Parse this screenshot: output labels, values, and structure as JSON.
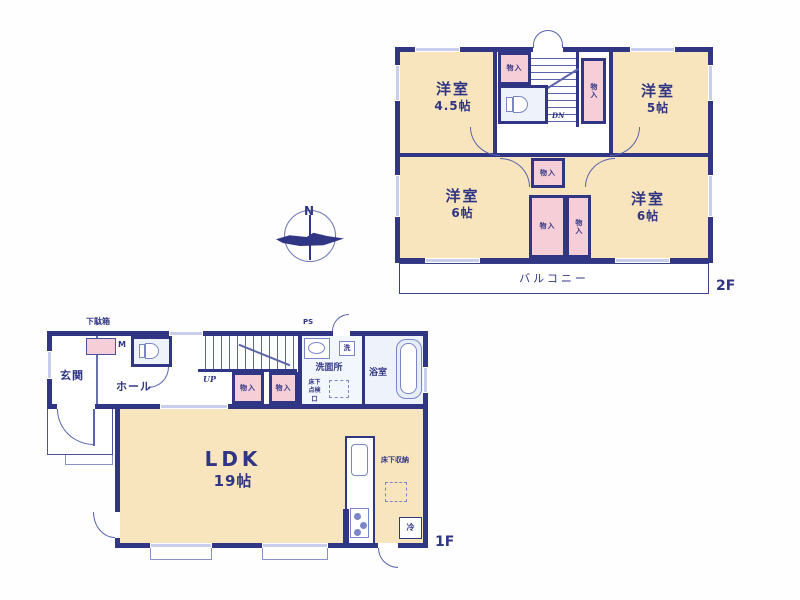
{
  "compass": {
    "label": "N"
  },
  "colors": {
    "wall": "#303683",
    "room_fill": "#f8e4bd",
    "closet_fill": "#f6ced7",
    "wet_fill": "#eef3fb",
    "window": "#c9cdee"
  },
  "floor2": {
    "label": "2F",
    "rooms": [
      {
        "name": "bedroom-nw",
        "label": "洋室",
        "size": "4.5帖"
      },
      {
        "name": "bedroom-ne",
        "label": "洋室",
        "size": "5帖"
      },
      {
        "name": "bedroom-sw",
        "label": "洋室",
        "size": "6帖"
      },
      {
        "name": "bedroom-se",
        "label": "洋室",
        "size": "6帖"
      }
    ],
    "closet_label": "物入",
    "stairs_label": "DN",
    "balcony_label": "バルコニー"
  },
  "floor1": {
    "label": "1F",
    "entrance_label": "玄関",
    "hall_label": "ホール",
    "shoe_cabinet_label": "下駄箱",
    "meter_label": "M",
    "stairs_label": "UP",
    "closet_label": "物入",
    "ps_label": "PS",
    "washroom_label": "洗面所",
    "washer_label": "洗",
    "inspection_label": "床下点検口",
    "bath_label": "浴室",
    "ldk_label": "LDK",
    "ldk_size": "19帖",
    "storage_label": "床下収納",
    "fridge_label": "冷"
  }
}
